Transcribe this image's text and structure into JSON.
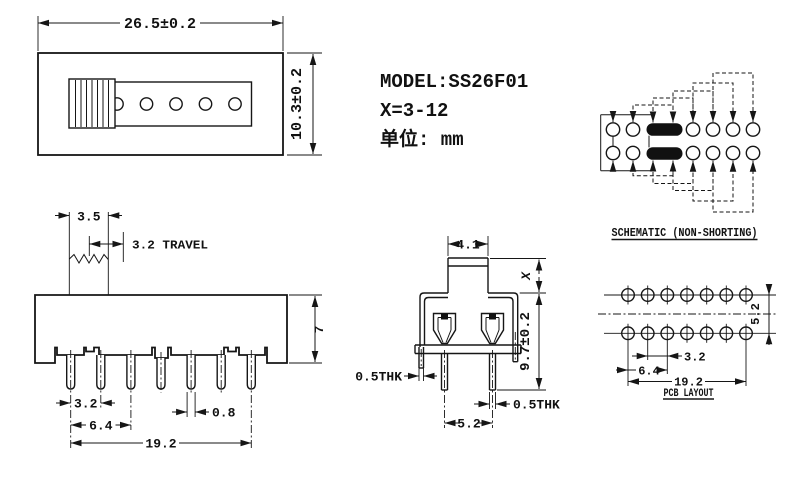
{
  "title_block": {
    "model": "MODEL:SS26F01",
    "positions": "X=3-12",
    "unit": "单位: mm"
  },
  "top_view": {
    "width_dim": "26.5±0.2",
    "height_dim": "10.3±0.2"
  },
  "front_view": {
    "knob_width_dim": "3.5",
    "travel_dim": "3.2 TRAVEL",
    "body_height_dim": "7",
    "pin_pitch_dim": "3.2",
    "pin_pitch2_dim": "6.4",
    "pin_width_dim": "0.8",
    "pin_span_dim": "19.2"
  },
  "side_view": {
    "knob_width_dim": "4.1",
    "knob_height_dim": "X",
    "body_height_dim": "9.7±0.2",
    "tab_thickness_dim": "0.5THK",
    "pin_thickness_dim": "0.5THK",
    "pin_pitch_dim": "5.2"
  },
  "schematic": {
    "title": "SCHEMATIC (NON-SHORTING)"
  },
  "pcb_layout": {
    "title": "PCB LAYOUT",
    "hole_pitch_dim": "3.2",
    "hole_pitch2_dim": "6.4",
    "hole_span_dim": "19.2",
    "row_pitch_dim": "5.2"
  }
}
